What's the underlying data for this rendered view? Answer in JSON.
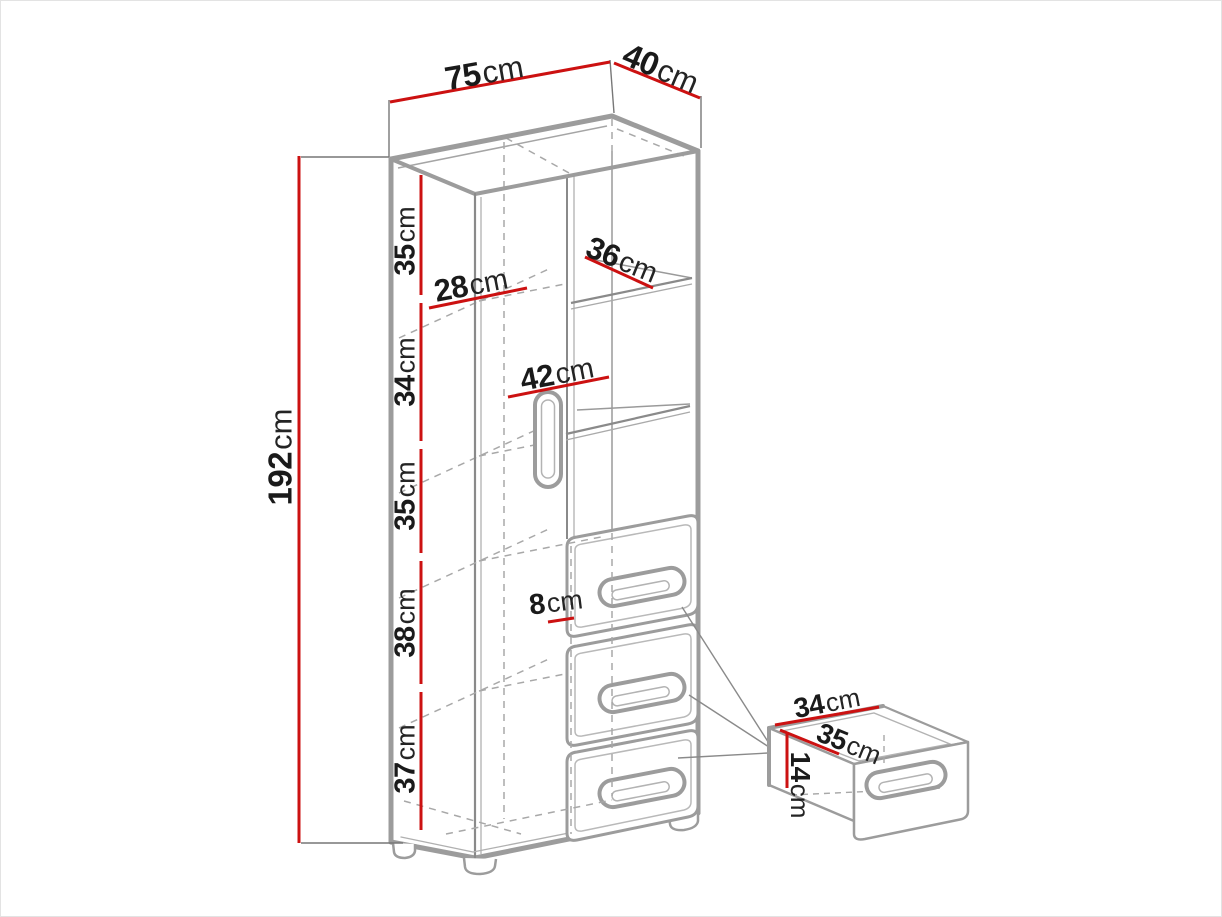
{
  "diagram_title": "cabinet dimension drawing",
  "colors": {
    "dimension_red": "#cc1111",
    "edge_gray": "#9c9c9c",
    "hidden_line_gray": "#a8a8a8",
    "text_black": "#1a1a1a",
    "background": "#ffffff"
  },
  "cabinet": {
    "width": {
      "value": "75",
      "unit": "cm"
    },
    "depth": {
      "value": "40",
      "unit": "cm"
    },
    "height": {
      "value": "192",
      "unit": "cm"
    },
    "sections": [
      {
        "value": "35",
        "unit": "cm"
      },
      {
        "value": "34",
        "unit": "cm"
      },
      {
        "value": "35",
        "unit": "cm"
      },
      {
        "value": "38",
        "unit": "cm"
      },
      {
        "value": "37",
        "unit": "cm"
      }
    ],
    "shelf_left_width": {
      "value": "28",
      "unit": "cm"
    },
    "shelf_top_depth": {
      "value": "36",
      "unit": "cm"
    },
    "shelf_mid_width": {
      "value": "42",
      "unit": "cm"
    },
    "small_dimension": {
      "value": "8",
      "unit": "cm"
    }
  },
  "drawer_detail": {
    "width": {
      "value": "34",
      "unit": "cm"
    },
    "depth": {
      "value": "35",
      "unit": "cm"
    },
    "height": {
      "value": "14",
      "unit": "cm"
    }
  }
}
